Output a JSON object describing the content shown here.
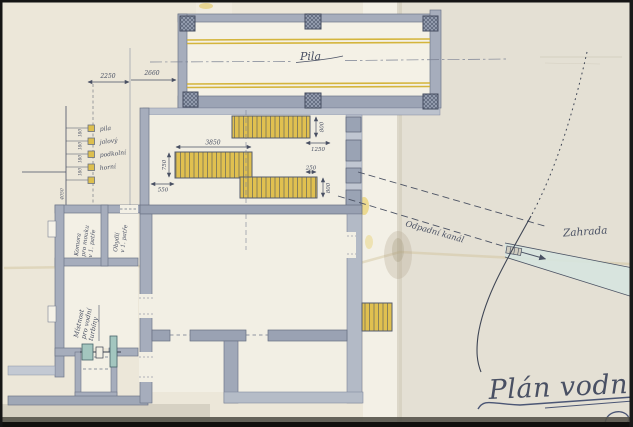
{
  "drawing": {
    "title": "Plán vodního",
    "labels": {
      "pila": "Pila",
      "odpadni_kanal": "Odpadní kanál",
      "zahrada": "Zahrada"
    },
    "rooms": {
      "komora": [
        "Komora",
        "pro mouku",
        "v 1. patře"
      ],
      "obydli": [
        "Obydlí",
        "v 1. patře"
      ],
      "mistnost": [
        "Místnost",
        "pro vodní",
        "turbíny"
      ]
    },
    "levels": {
      "names": [
        "pila",
        "jalový",
        "podkolní",
        "horní"
      ],
      "ticks": [
        "180",
        "180",
        "180",
        "180"
      ],
      "total": "4050"
    },
    "dimensions": {
      "d2250": "2250",
      "d2660": "2660",
      "barA_h": "800",
      "barA_off": "1250",
      "barB_w": "3850",
      "barB_h": "750",
      "barB_off": "550",
      "barC_off": "250",
      "barC_h": "800"
    },
    "colors": {
      "wall": "#a6adbc",
      "wall_dark": "#6e7689",
      "yellow": "#e0c050",
      "ink": "#495063",
      "water": "#d6e4df",
      "paper": "#ece7d9"
    }
  }
}
